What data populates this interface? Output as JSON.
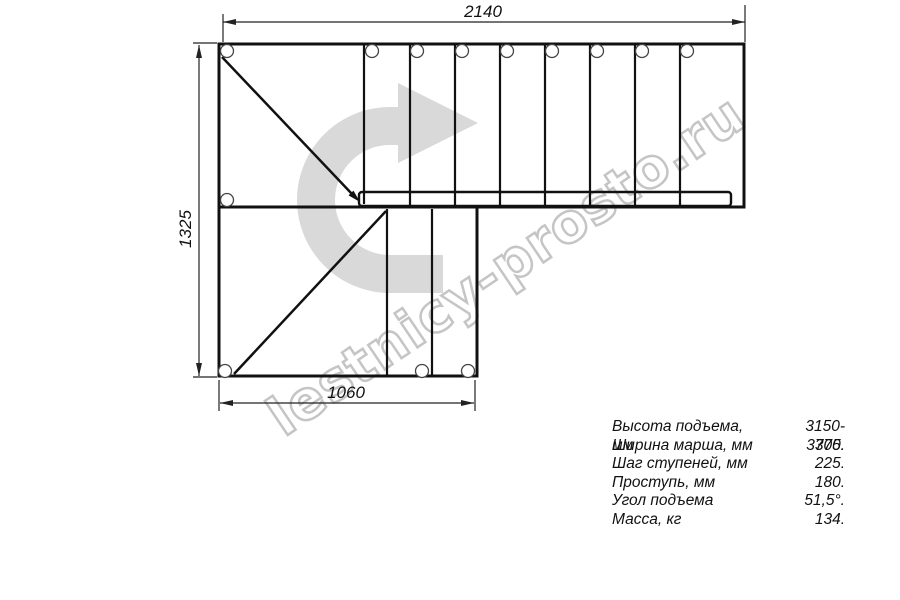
{
  "dimensions": {
    "width_top": "2140",
    "height_left": "1325",
    "width_bottom": "1060"
  },
  "watermark": "lestnicy-prosto.ru",
  "specs": [
    {
      "label": "Высота подъема, мм",
      "value": "3150-3375."
    },
    {
      "label": "Ширина марша, мм",
      "value": "700."
    },
    {
      "label": "Шаг ступеней, мм",
      "value": "225."
    },
    {
      "label": "Проступь, мм",
      "value": "180."
    },
    {
      "label": "Угол подъема",
      "value": "51,5°."
    },
    {
      "label": "Масса, кг",
      "value": "134."
    }
  ],
  "colors": {
    "line": "#111111",
    "dimension_line": "#222222",
    "arrow_fill": "#d9d9d9",
    "watermark": "#c5c5c5",
    "background": "#ffffff"
  }
}
